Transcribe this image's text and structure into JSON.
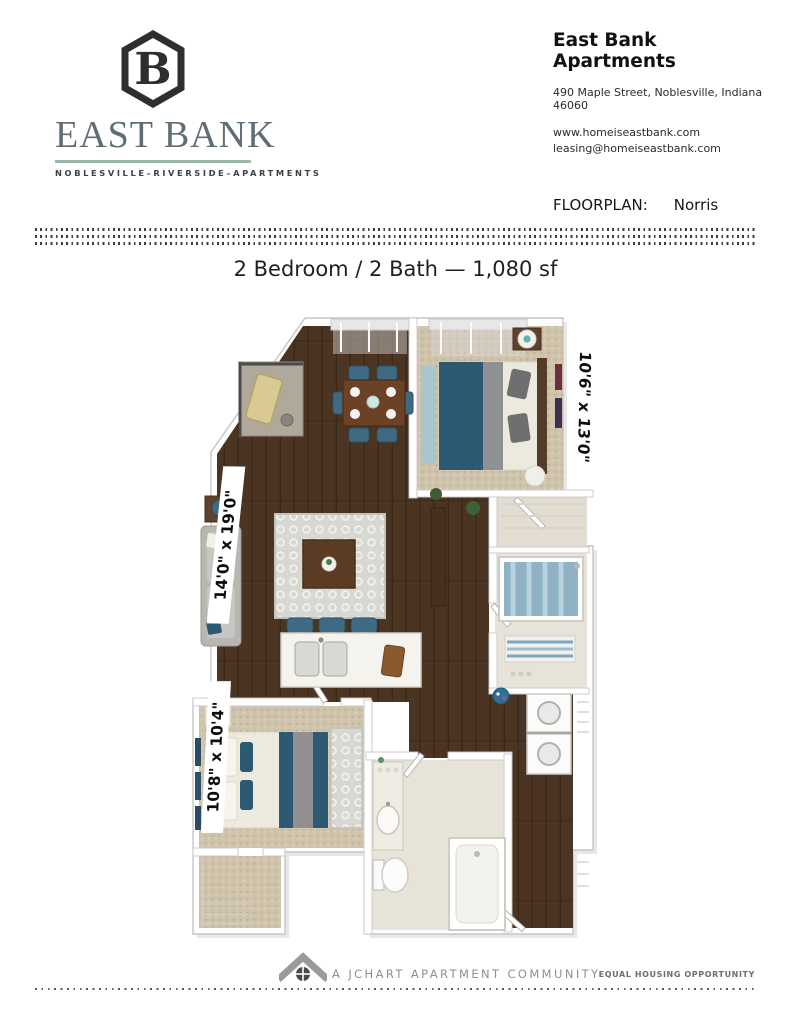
{
  "brand": {
    "name": "EAST BANK",
    "tagline": "NOBLESVILLE–RIVERSIDE–APARTMENTS",
    "mark": "hexagon-b-monogram",
    "colors": {
      "brand_text": "#5f6d74",
      "underline": "#9eb8a8",
      "mark": "#2e2e2e"
    }
  },
  "contact": {
    "title": "East Bank Apartments",
    "address": "490 Maple Street, Noblesville, Indiana 46060",
    "website": "www.homeiseastbank.com",
    "email": "leasing@homeiseastbank.com"
  },
  "floorplan": {
    "label": "FLOORPLAN:",
    "name": "Norris",
    "title": "2 Bedroom / 2 Bath — 1,080 sf",
    "beds": 2,
    "baths": 2,
    "square_feet": "1,080",
    "dimensions": {
      "master_bedroom": "10'6\" x 13'0\"",
      "living_room": "14'0\" x 19'0\"",
      "bedroom_2": "10'8\" x 10'4\""
    }
  },
  "plan_colors": {
    "wood_floor": "#4c3422",
    "carpet": "#cfc3ab",
    "tile": "#e7e3d8",
    "accent_teal": "#2d5a73",
    "rug_gray": "#d8d8d3"
  },
  "footer": {
    "community": "A JCHART APARTMENT COMMUNITY",
    "equal_housing": "EQUAL HOUSING OPPORTUNITY",
    "icon": "roof-window-icon"
  }
}
